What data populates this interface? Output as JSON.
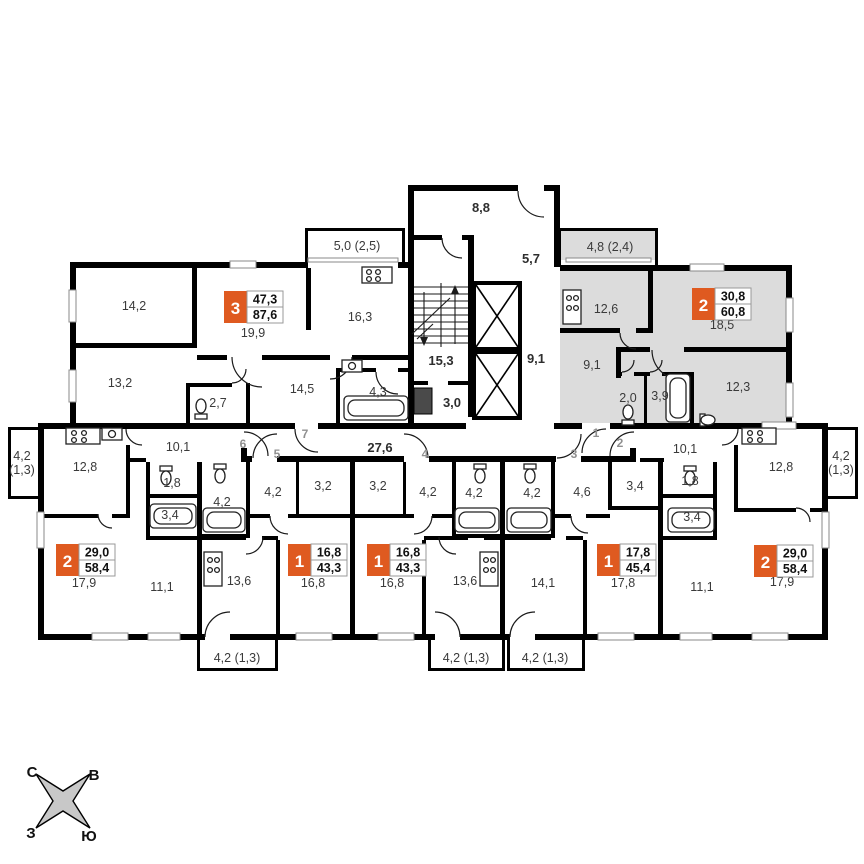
{
  "colors": {
    "wall": "#000000",
    "badge_orange": "#df5a20",
    "selected_apartment_fill": "#dcdcdc",
    "room_text": "#3a3a3a",
    "door_number_text": "#8f8f8f"
  },
  "common_areas": {
    "vestibule": "8,8",
    "upper_hall": "5,7",
    "stair_landing": "15,3",
    "lobby": "3,0",
    "elevator_hall": "9,1",
    "corridor": "27,6"
  },
  "apartments": [
    {
      "position": "top-left",
      "door": "7",
      "rooms_count": "3",
      "area_living": "47,3",
      "area_total": "87,6",
      "selected": false,
      "rooms": {
        "living": "19,9",
        "bedroom_1": "14,2",
        "bedroom_2": "13,2",
        "kitchen": "16,3",
        "hall": "14,5",
        "wc": "2,7",
        "bathroom": "4,3",
        "balcony": "5,0 (2,5)"
      }
    },
    {
      "position": "top-right",
      "door": "1",
      "rooms_count": "2",
      "area_living": "30,8",
      "area_total": "60,8",
      "selected": true,
      "rooms": {
        "living": "18,5",
        "kitchen": "12,6",
        "bedroom": "12,3",
        "hall": "9,1",
        "wc": "2,0",
        "bathroom": "3,9",
        "balcony": "4,8 (2,4)"
      }
    },
    {
      "position": "bottom-left",
      "door": "6",
      "rooms_count": "2",
      "area_living": "29,0",
      "area_total": "58,4",
      "selected": false,
      "rooms": {
        "living": "17,9",
        "bedroom": "11,1",
        "kitchen": "12,8",
        "hall": "10,1",
        "wc": "1,8",
        "bathroom": "3,4",
        "balcony_line1": "4,2",
        "balcony_line2": "(1,3)"
      }
    },
    {
      "position": "bottom-mid-1",
      "door": "5",
      "rooms_count": "1",
      "area_living": "16,8",
      "area_total": "43,3",
      "selected": false,
      "rooms": {
        "living": "16,8",
        "kitchen": "13,6",
        "hall": "4,2",
        "inner_corridor": "3,2",
        "bathroom": "4,2",
        "balcony": "4,2 (1,3)"
      }
    },
    {
      "position": "bottom-mid-2",
      "door": "4",
      "rooms_count": "1",
      "area_living": "16,8",
      "area_total": "43,3",
      "selected": false,
      "rooms": {
        "living": "16,8",
        "kitchen": "13,6",
        "hall": "4,2",
        "inner_corridor": "3,2",
        "bathroom": "4,2",
        "balcony": "4,2 (1,3)"
      }
    },
    {
      "position": "bottom-mid-3",
      "door": "3",
      "rooms_count": "1",
      "area_living": "17,8",
      "area_total": "45,4",
      "selected": false,
      "rooms": {
        "living": "17,8",
        "kitchen": "14,1",
        "hall": "4,6",
        "storage": "3,4",
        "bathroom": "4,2",
        "balcony": "4,2 (1,3)"
      }
    },
    {
      "position": "bottom-right",
      "door": "2",
      "rooms_count": "2",
      "area_living": "29,0",
      "area_total": "58,4",
      "selected": false,
      "rooms": {
        "living": "17,9",
        "bedroom": "11,1",
        "kitchen": "12,8",
        "hall": "10,1",
        "wc": "1,8",
        "bathroom": "3,4",
        "balcony_line1": "4,2",
        "balcony_line2": "(1,3)"
      }
    }
  ],
  "compass": {
    "north": "С",
    "east": "В",
    "west": "З",
    "south": "Ю"
  }
}
